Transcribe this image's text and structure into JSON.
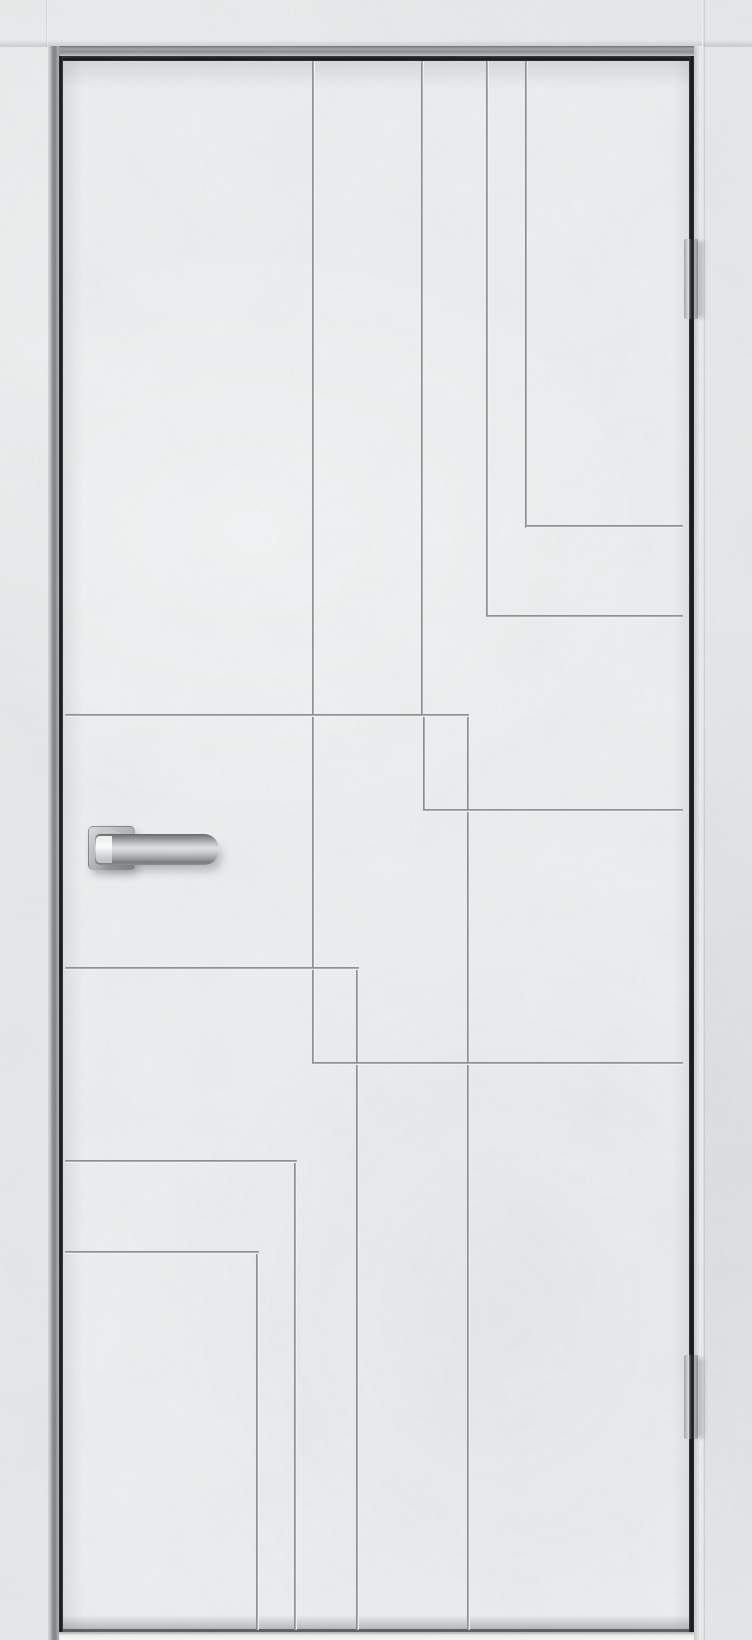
{
  "scene": {
    "kind": "interior-door-product-photo",
    "width": 752,
    "height": 1640,
    "wall_color": "#e6e8e9",
    "floor_color": "#f2f3f3"
  },
  "door": {
    "x": 62,
    "y": 60,
    "width": 628,
    "height": 1572,
    "face_color": "#eceeef",
    "edge_gap_color": "#0d0e0f",
    "bottom_edge_color": "#5a5e60"
  },
  "frame": {
    "head_y": 46,
    "joint_left_x": 48,
    "joint_right_x": 703,
    "metal_color": "#8a8d8f"
  },
  "grooves": {
    "thickness": 3,
    "line_color": "#878c8f",
    "highlight_color": "#f3f4f4",
    "vertical": [
      {
        "x": 313,
        "y1": 61,
        "y2": 1064
      },
      {
        "x": 422,
        "y1": 61,
        "y2": 717
      },
      {
        "x": 487,
        "y1": 61,
        "y2": 617
      },
      {
        "x": 526,
        "y1": 61,
        "y2": 528
      },
      {
        "x": 424,
        "y1": 716,
        "y2": 811
      },
      {
        "x": 468,
        "y1": 716,
        "y2": 1630
      },
      {
        "x": 357,
        "y1": 968,
        "y2": 1630
      },
      {
        "x": 295,
        "y1": 1161,
        "y2": 1630
      },
      {
        "x": 257,
        "y1": 1252,
        "y2": 1630
      }
    ],
    "horizontal": [
      {
        "y": 526,
        "x1": 526,
        "x2": 683
      },
      {
        "y": 616,
        "x1": 487,
        "x2": 683
      },
      {
        "y": 715,
        "x1": 65,
        "x2": 469
      },
      {
        "y": 810,
        "x1": 424,
        "x2": 683
      },
      {
        "y": 968,
        "x1": 65,
        "x2": 359
      },
      {
        "y": 1063,
        "x1": 313,
        "x2": 683
      },
      {
        "y": 1161,
        "x1": 65,
        "x2": 297
      },
      {
        "y": 1252,
        "x1": 65,
        "x2": 259
      }
    ]
  },
  "hinges": {
    "x": 684,
    "width": 14,
    "color": "#8b9093",
    "seam_color": "#5e6264",
    "items": [
      {
        "name": "hinge-top",
        "y": 239,
        "height": 80
      },
      {
        "name": "hinge-bottom",
        "y": 1355,
        "height": 84
      }
    ]
  },
  "handle": {
    "finish": "brushed-chrome",
    "rose": {
      "x": 88,
      "y": 826,
      "width": 45,
      "height": 42
    },
    "lever": {
      "x": 95,
      "y": 834,
      "width": 124,
      "height": 31
    },
    "neck_highlight": {
      "x": 96,
      "y": 836,
      "width": 16,
      "height": 27
    },
    "metal_light": "#dfe2e3",
    "metal_mid": "#aab0b3",
    "metal_dark": "#6e7275"
  }
}
